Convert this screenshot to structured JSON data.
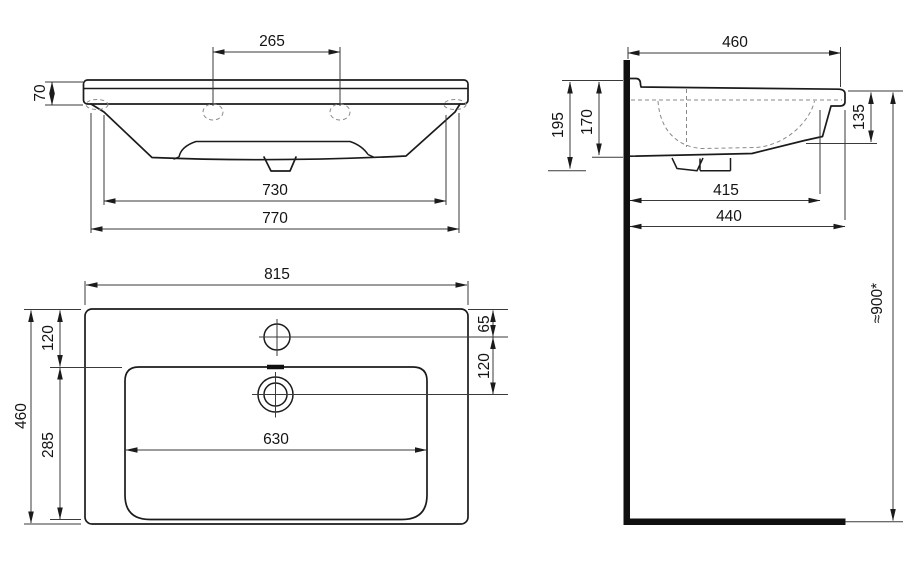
{
  "drawing": {
    "type": "technical-drawing",
    "subject": "wall-mounted washbasin, three orthographic views with dimensions (mm)",
    "colors": {
      "background": "#ffffff",
      "line": "#1b1b1b",
      "dashed": "#8a8a8a"
    },
    "front_view": {
      "hole_spacing": "265",
      "rim_height": "70",
      "inner_width": "730",
      "body_width": "770"
    },
    "side_view": {
      "depth": "460",
      "height_total": "195",
      "height_to_bottom": "170",
      "front_edge_height": "135",
      "inner_depth": "415",
      "body_depth": "440",
      "mounting_height": "≈900*"
    },
    "plan_view": {
      "overall_width": "815",
      "overall_depth": "460",
      "back_to_basin": "120",
      "basin_depth": "285",
      "faucet_offset": "65",
      "faucet_to_drain": "120",
      "basin_width": "630"
    }
  }
}
